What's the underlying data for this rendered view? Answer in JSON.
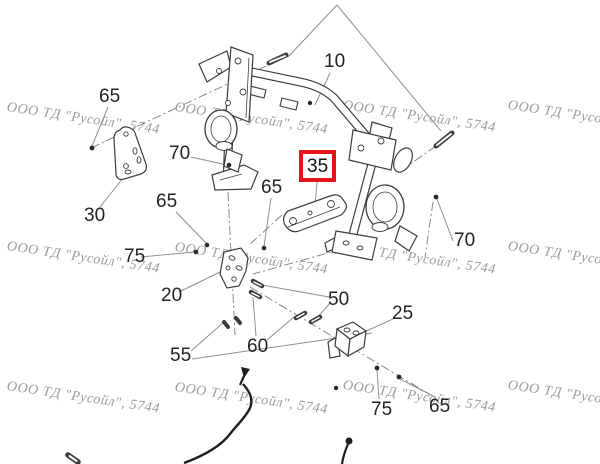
{
  "page": {
    "width": 600,
    "height": 464,
    "background": "#ffffff",
    "type": "parts-diagram"
  },
  "watermark": {
    "text": "ООО ТД \"Русойл\", 5744",
    "color": "#9b9b9b",
    "angle_deg": 8.5,
    "positions": [
      [
        8,
        100
      ],
      [
        176,
        100
      ],
      [
        344,
        98
      ],
      [
        509,
        98
      ],
      [
        8,
        239
      ],
      [
        176,
        240
      ],
      [
        344,
        240
      ],
      [
        509,
        239
      ],
      [
        8,
        379
      ],
      [
        176,
        380
      ],
      [
        344,
        378
      ],
      [
        509,
        378
      ]
    ]
  },
  "highlight": {
    "border_color": "#e0161d",
    "background": "#ffffff",
    "text_color": "#111111"
  },
  "callouts": [
    {
      "id": "40-top",
      "text": "40",
      "x": 327,
      "y": -16,
      "clipped": true
    },
    {
      "id": "10",
      "text": "10",
      "x": 324,
      "y": 52
    },
    {
      "id": "65-top-left",
      "text": "65",
      "x": 99,
      "y": 87
    },
    {
      "id": "70-left",
      "text": "70",
      "x": 169,
      "y": 144
    },
    {
      "id": "65-mid-left",
      "text": "65",
      "x": 156,
      "y": 192
    },
    {
      "id": "65-center",
      "text": "65",
      "x": 261,
      "y": 178
    },
    {
      "id": "30",
      "text": "30",
      "x": 84,
      "y": 206
    },
    {
      "id": "35",
      "text": "35",
      "x": 299,
      "y": 150,
      "highlighted": true
    },
    {
      "id": "70-right",
      "text": "70",
      "x": 454,
      "y": 231
    },
    {
      "id": "75-left",
      "text": "75",
      "x": 124,
      "y": 247
    },
    {
      "id": "20",
      "text": "20",
      "x": 161,
      "y": 286
    },
    {
      "id": "50",
      "text": "50",
      "x": 328,
      "y": 290
    },
    {
      "id": "25",
      "text": "25",
      "x": 392,
      "y": 304
    },
    {
      "id": "60",
      "text": "60",
      "x": 247,
      "y": 337
    },
    {
      "id": "55",
      "text": "55",
      "x": 170,
      "y": 346
    },
    {
      "id": "75-bottom",
      "text": "75",
      "x": 371,
      "y": 400
    },
    {
      "id": "65-bottom",
      "text": "65",
      "x": 429,
      "y": 397
    }
  ],
  "diagram": {
    "description": "Exploded-view parts diagram: roll-bar frame (10) with two seat-belt retractor assemblies, mounting brackets (20, 25, 30, 35), and fasteners (50, 55, 60, 65, 70, 75); part 35 is highlighted with a red box",
    "line_color": "#3c3c3c",
    "leader_color": "#8f8f8f"
  }
}
